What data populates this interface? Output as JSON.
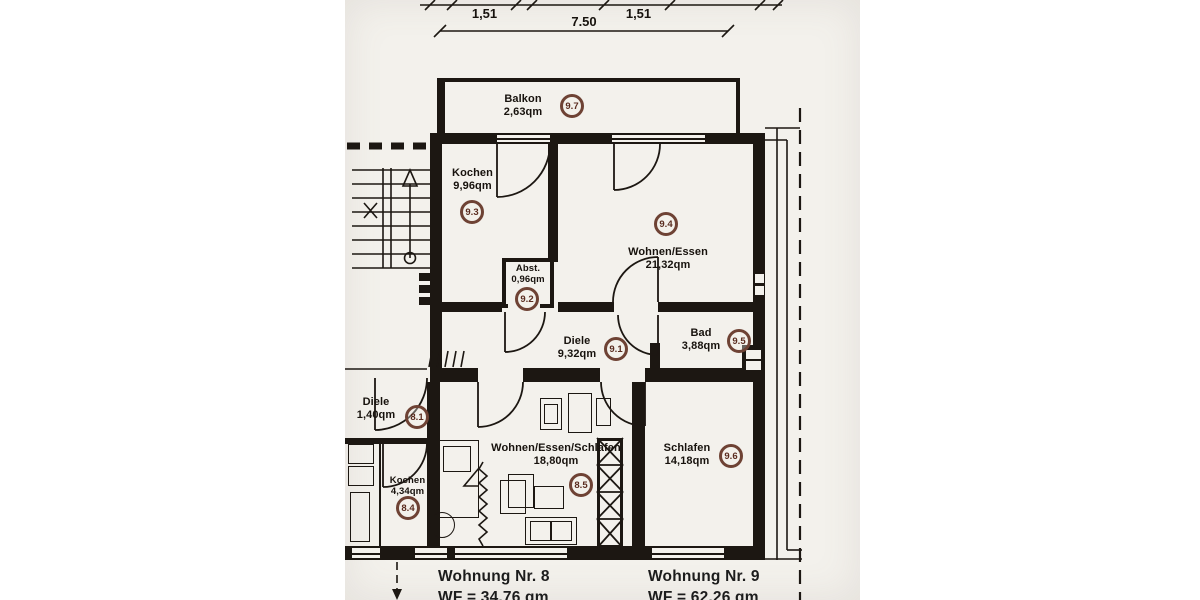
{
  "plan": {
    "type": "apartment-floor-plan",
    "dimensions": {
      "segment_left": "1,51",
      "segment_right": "1,51",
      "overall_width": "7.50"
    },
    "rooms": {
      "balkon": {
        "name": "Balkon",
        "area": "2,63qm",
        "ref": "9.7"
      },
      "kochen9": {
        "name": "Kochen",
        "area": "9,96qm",
        "ref": "9.3"
      },
      "wohnen_essen": {
        "name": "Wohnen/Essen",
        "area": "21,32qm",
        "ref": "9.4"
      },
      "abst": {
        "name": "Abst.",
        "area": "0,96qm",
        "ref": "9.2"
      },
      "diele9": {
        "name": "Diele",
        "area": "9,32qm",
        "ref": "9.1"
      },
      "bad": {
        "name": "Bad",
        "area": "3,88qm",
        "ref": "9.5"
      },
      "diele8": {
        "name": "Diele",
        "area": "1,40qm",
        "ref": "8.1"
      },
      "kochen8": {
        "name": "Kochen",
        "area": "4,34qm",
        "ref": "8.4"
      },
      "wohnen_essen_schlafen": {
        "name": "Wohnen/Essen/Schlafen",
        "area": "18,80qm",
        "ref": "8.5"
      },
      "schlafen": {
        "name": "Schlafen",
        "area": "14,18qm",
        "ref": "9.6"
      }
    },
    "apartments": {
      "nr8": {
        "label": "Wohnung Nr. 8",
        "wf": "WF = 34,76 qm"
      },
      "nr9": {
        "label": "Wohnung Nr. 9",
        "wf": "WF = 62,26 qm"
      }
    },
    "colors": {
      "ink": "#1c1712",
      "paper": "#f3f1ec",
      "badge_ring": "#6e4234",
      "badge_text": "#5a2c1f"
    }
  }
}
